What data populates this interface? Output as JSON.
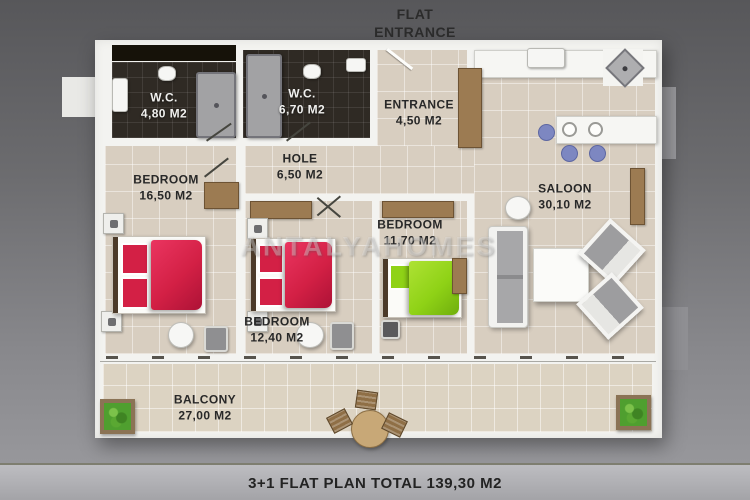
{
  "title": {
    "line1": "FLAT",
    "line2": "ENTRANCE"
  },
  "watermark": "ANTALYAHOMES",
  "footer": {
    "caption": "3+1 FLAT PLAN TOTAL 139,30 M2"
  },
  "rooms": {
    "wc1": {
      "name": "W.C.",
      "area": "4,80 M2"
    },
    "wc2": {
      "name": "W.C.",
      "area": "6,70 M2"
    },
    "entrance": {
      "name": "ENTRANCE",
      "area": "4,50 M2"
    },
    "hole": {
      "name": "HOLE",
      "area": "6,50 M2"
    },
    "bedroom_large": {
      "name": "BEDROOM",
      "area": "16,50 M2"
    },
    "bedroom_middle": {
      "name": "BEDROOM",
      "area": "12,40 M2"
    },
    "bedroom_small": {
      "name": "BEDROOM",
      "area": "11,70 M2"
    },
    "saloon": {
      "name": "SALOON",
      "area": "30,10 M2"
    },
    "balcony": {
      "name": "BALCONY",
      "area": "27,00 M2"
    }
  },
  "colors": {
    "bed_red": "#d32045",
    "bed_green": "#8fd216",
    "stool_blue": "#7d87c1",
    "plant_green": "#4f9f2f",
    "floor_tile": "#d8cec0",
    "dark_tile": "#2f2a24",
    "wall_white": "#f3f3f0",
    "background_gray": "#6c6c6f"
  }
}
